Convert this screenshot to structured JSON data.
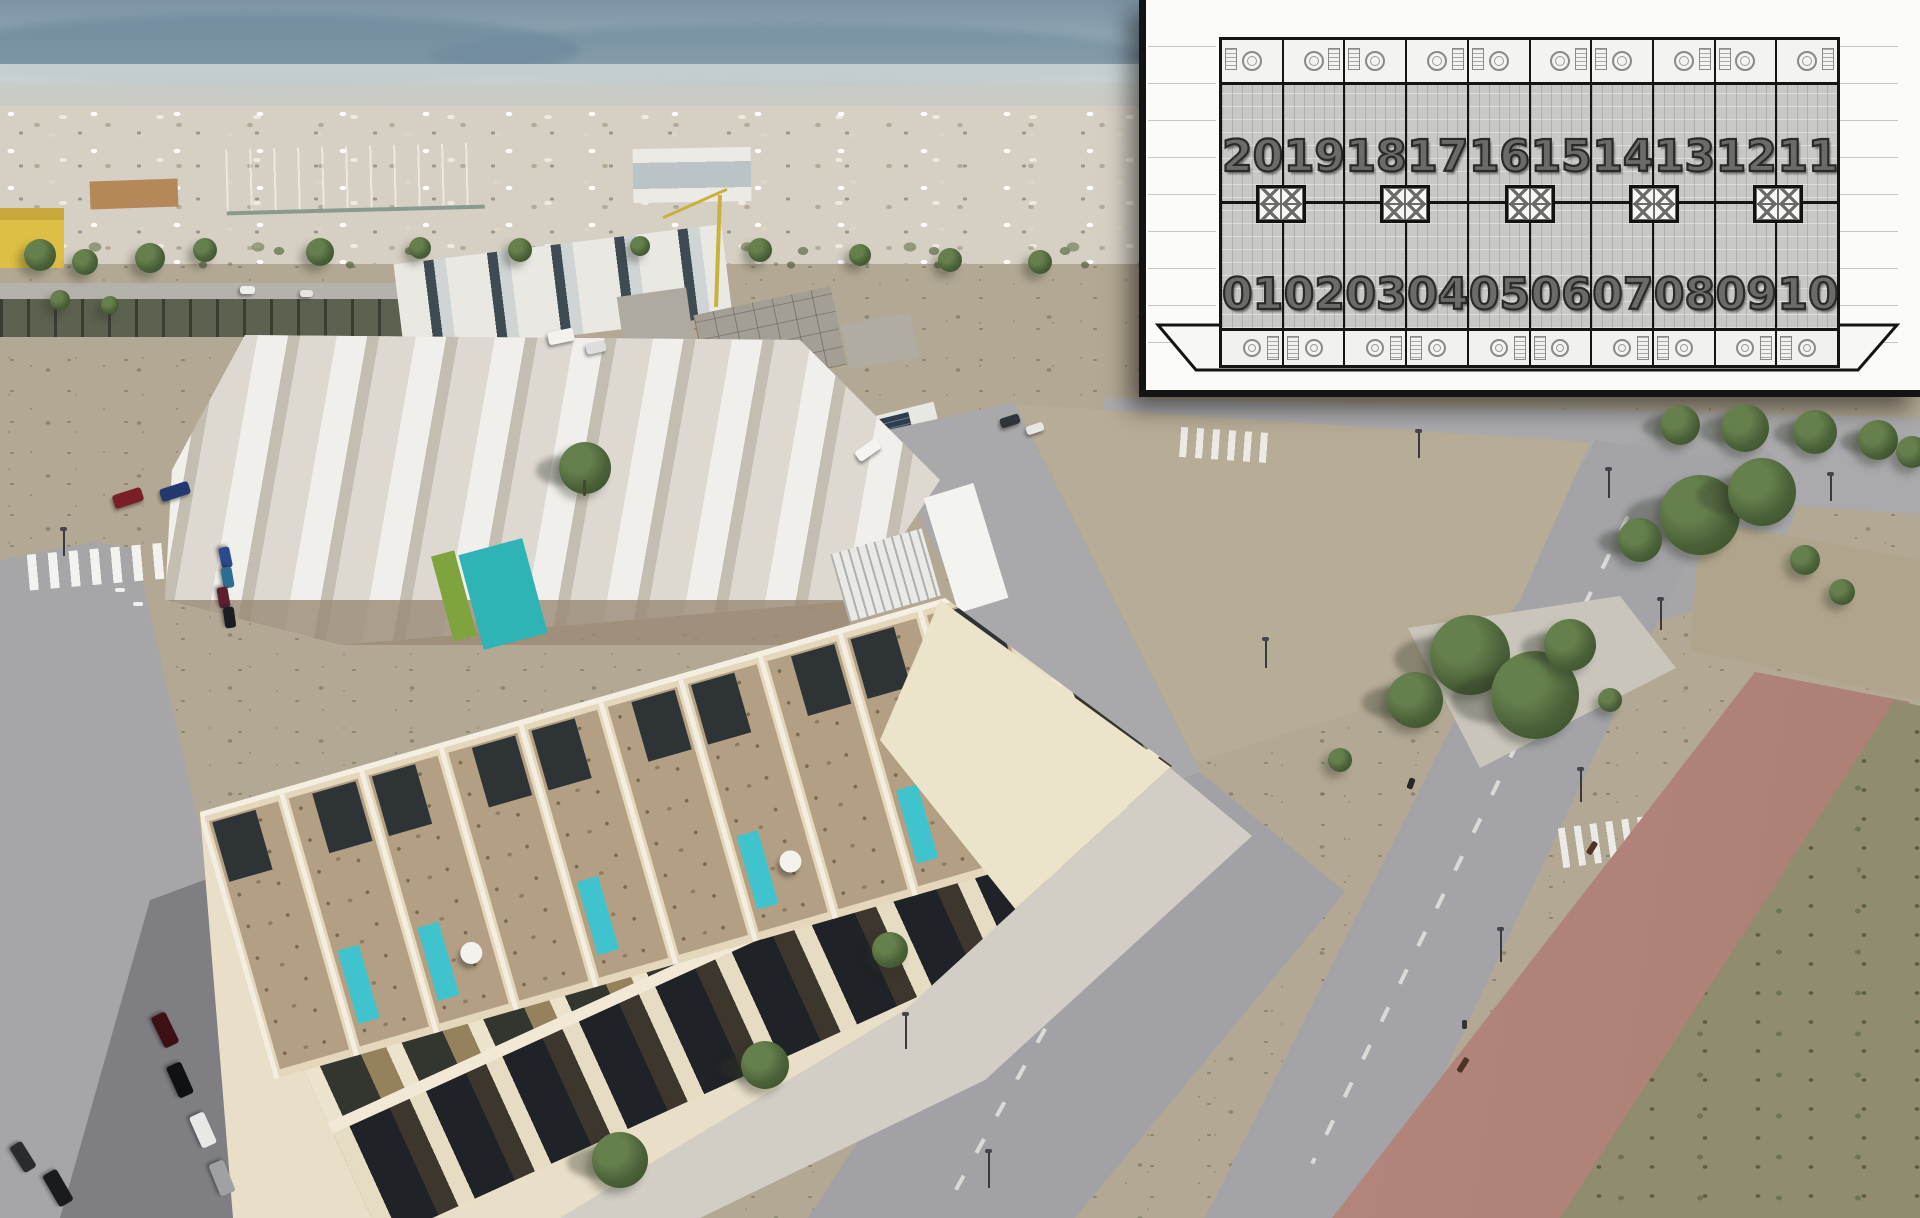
{
  "floor_plan": {
    "title": "Site plan overlay — 20 townhouse units in two facing rows",
    "units": [
      {
        "upper": "20",
        "lower": "01"
      },
      {
        "upper": "19",
        "lower": "02"
      },
      {
        "upper": "18",
        "lower": "03"
      },
      {
        "upper": "17",
        "lower": "04"
      },
      {
        "upper": "16",
        "lower": "05"
      },
      {
        "upper": "15",
        "lower": "06"
      },
      {
        "upper": "14",
        "lower": "07"
      },
      {
        "upper": "13",
        "lower": "08"
      },
      {
        "upper": "12",
        "lower": "09"
      },
      {
        "upper": "11",
        "lower": "10"
      }
    ],
    "upper_row": [
      "20",
      "19",
      "18",
      "17",
      "16",
      "15",
      "14",
      "13",
      "12",
      "11"
    ],
    "lower_row": [
      "01",
      "02",
      "03",
      "04",
      "05",
      "06",
      "07",
      "08",
      "09",
      "10"
    ],
    "icons": {
      "terrace_table": "round-table-icon",
      "stairs": "stairs-hatch-icon",
      "shaft": "crossed-box-icon"
    },
    "colors": {
      "paper": "#fbfbfa",
      "unit_body": "#c8c8c6",
      "terrace": "#f3f3f1",
      "outline": "#151515",
      "number_fill": "#6b6b69",
      "number_outline": "#2a2a28"
    }
  },
  "scene": {
    "description_colors": {
      "hero_building_cream": "#e9dfc9",
      "roof_terrace_floor": "#b3a084",
      "plunge_pool_teal": "#3fc3cd",
      "pergola_dark": "#2e3336",
      "road_gray": "#a6a6a8",
      "sidewalk": "#d2cec5",
      "dirt_lot": "#b7ac96",
      "red_promenade": "#bb8a7f",
      "riverbank_vegetation": "#8f8c6f",
      "community_pool_teal": "#2fb4b6",
      "hedge_green": "#7fa33d",
      "crane_yellow": "#c8b13c",
      "warehouse_roof_green": "#a9bfae",
      "mountain_haze_blue": "#7b93a5"
    }
  }
}
